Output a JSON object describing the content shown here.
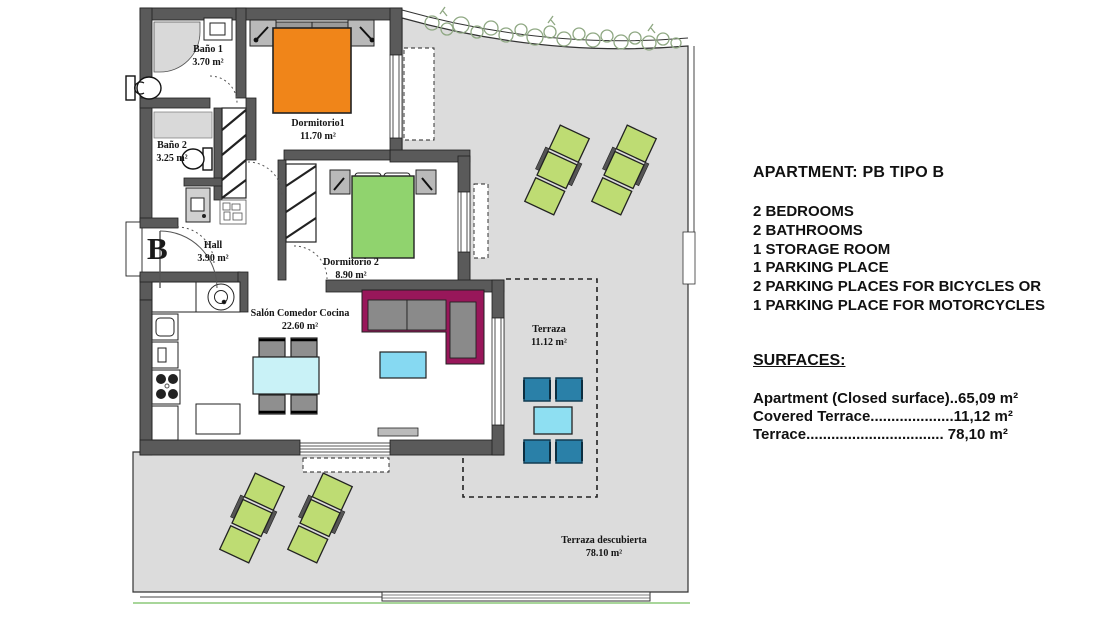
{
  "plan": {
    "unit_letter": "B",
    "rooms": [
      {
        "name": "Baño 1",
        "area": "3.70 m²"
      },
      {
        "name": "Baño 2",
        "area": "3.25 m²"
      },
      {
        "name": "Dormitorio1",
        "area": "11.70 m²"
      },
      {
        "name": "Dormitorio 2",
        "area": "8.90 m²"
      },
      {
        "name": "Hall",
        "area": "3.90 m²"
      },
      {
        "name": "Salón Comedor Cocina",
        "area": "22.60 m²"
      },
      {
        "name": "Terraza",
        "area": "11.12 m²"
      },
      {
        "name": "Terraza descubierta",
        "area": "78.10 m²"
      }
    ]
  },
  "info_panel": {
    "title": "APARTMENT: PB TIPO B",
    "features": [
      "2 BEDROOMS",
      "2 BATHROOMS",
      "1 STORAGE ROOM",
      "1 PARKING PLACE",
      "2 PARKING PLACES FOR BICYCLES OR",
      "1 PARKING PLACE FOR MOTORCYCLES"
    ],
    "surfaces_heading": "SURFACES:",
    "surfaces": [
      "Apartment (Closed surface)..65,09 m²",
      "Covered Terrace....................11,12 m²",
      "Terrace................................. 78,10 m²"
    ]
  },
  "colors": {
    "wall": "#5a5a5a",
    "terrace_floor": "#dcdcdc",
    "bed1_orange": "#f08519",
    "bed2_green": "#90d36e",
    "lounger_green": "#bedc73",
    "terrace_chair_teal": "#2a80a8",
    "dining_table_cyan": "#c9f2f7",
    "coffee_table_cyan": "#86d9f2",
    "terrace_table_cyan": "#8edff2",
    "sofa_magenta": "#98175a",
    "hedge_green": "#8fa883",
    "fence_green": "#a8d69a"
  }
}
